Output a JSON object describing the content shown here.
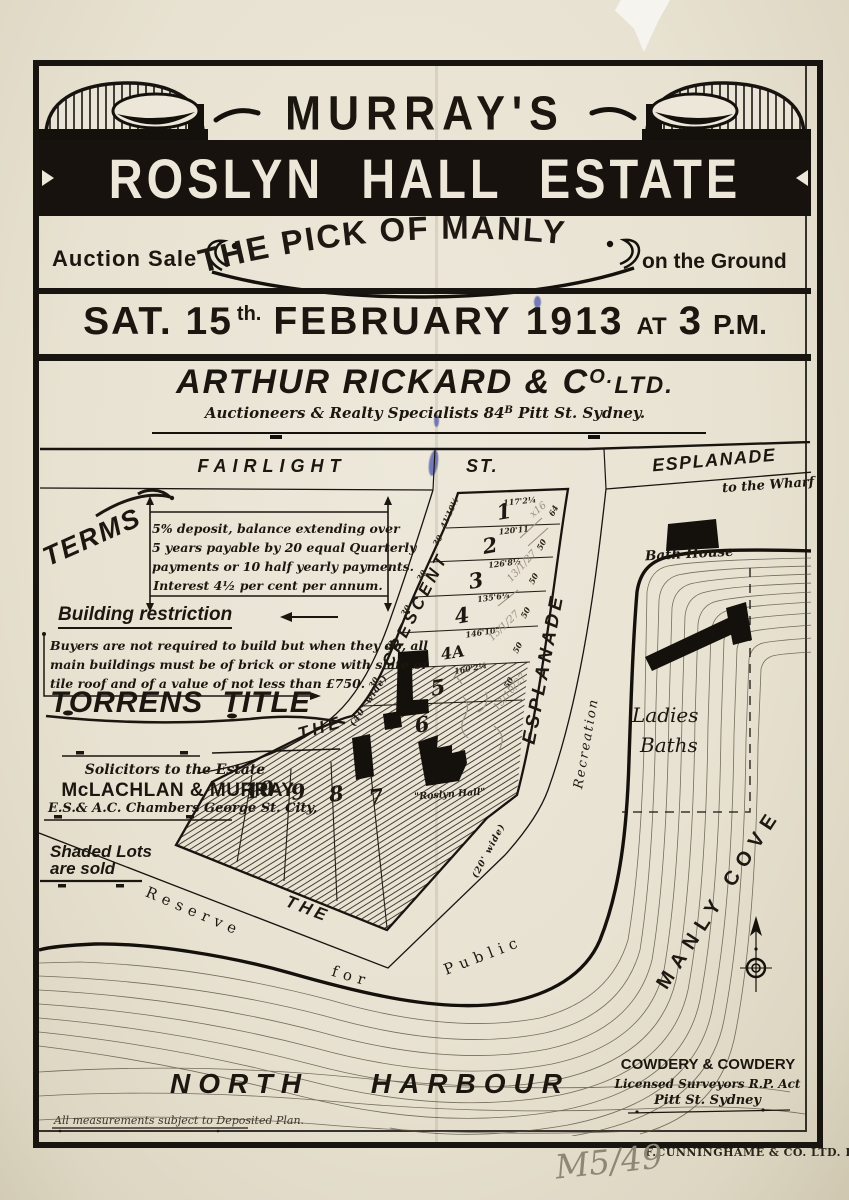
{
  "poster": {
    "brand": "MURRAY'S",
    "estate": "ROSLYN HALL ESTATE",
    "auction_left": "Auction Sale",
    "headline": "THE PICK OF MANLY",
    "auction_right": "on the Ground",
    "date": {
      "p1": "SAT. 15",
      "sup": "th.",
      "p2": "FEBRUARY 1913",
      "at": "AT",
      "time": "3",
      "pm": "P.M."
    },
    "agent": {
      "name_p1": "ARTHUR RICKARD & C",
      "name_sup": "O.",
      "name_p2": "LTD.",
      "sub_p1": "Auctioneers & Realty Specialists 84",
      "sub_sup": "B",
      "sub_p2": " Pitt St. Sydney."
    }
  },
  "left_panel": {
    "terms_label": "TERMS",
    "terms_lines": [
      "5% deposit, balance extending over",
      "5 years payable by 20 equal Quarterly",
      "payments or 10 half yearly payments.",
      "Interest 4½ per cent per annum."
    ],
    "building_heading": "Building restriction",
    "building_lines": [
      "Buyers are not required to build but when they do, all",
      "main buildings must be of brick or stone with slate or",
      "tile roof and of a value of not less than £750."
    ],
    "torrens": "TORRENS TITLE",
    "solicitors_caption": "Solicitors to the Estate",
    "solicitors_name": "McLACHLAN & MURRAY",
    "solicitors_address": "E.S.& A.C. Chambers George St. City,",
    "shaded_1": "Shaded Lots",
    "shaded_2": "are sold"
  },
  "map": {
    "streets": {
      "fairlight": "FAIRLIGHT",
      "st": "ST.",
      "esplanade_top": "ESPLANADE",
      "wharf": "to the Wharf",
      "the_crescent": "THE",
      "crescent": "CRESCENT",
      "width40": "(40' wide)",
      "esplanade_side": "ESPLANADE",
      "width20": "(20' wide)",
      "the_bottom": "THE"
    },
    "reserve": {
      "r1": "Reserve",
      "r2": "for",
      "r3": "Public",
      "r4": "Recreation"
    },
    "labels": {
      "bath_house": "Bath House",
      "ladies": "Ladies",
      "baths": "Baths",
      "manly_cove": "MANLY  COVE",
      "north_harbour": "NORTH HARBOUR",
      "roslyn_hall": "\"Roslyn Hall\""
    },
    "lot_numbers": [
      "1",
      "2",
      "3",
      "4",
      "4A",
      "5",
      "6",
      "7",
      "8",
      "9",
      "10"
    ],
    "dims": {
      "d1_top": "117'2¼",
      "d1_left": "41'10½",
      "d1_b": "120'11",
      "d2_b": "126'8½",
      "d3_b": "135'6¼",
      "d4_b": "146'10\"",
      "d4a_b": "160'2¼",
      "r64": "64",
      "fifty": "50",
      "thirty": "30"
    },
    "pencil": [
      "x16",
      "13/1/27",
      "15/1/27",
      "13/10/27"
    ],
    "surveyor": {
      "name": "COWDERY & COWDERY",
      "line2": "Licensed Surveyors R.P. Act",
      "line3": "Pitt St. Sydney"
    },
    "note": "All measurements subject to Deposited Plan."
  },
  "footer": {
    "litho": "F.CUNNINGHAME & CO. LTD. LITHO.",
    "ref": "M5/49"
  }
}
